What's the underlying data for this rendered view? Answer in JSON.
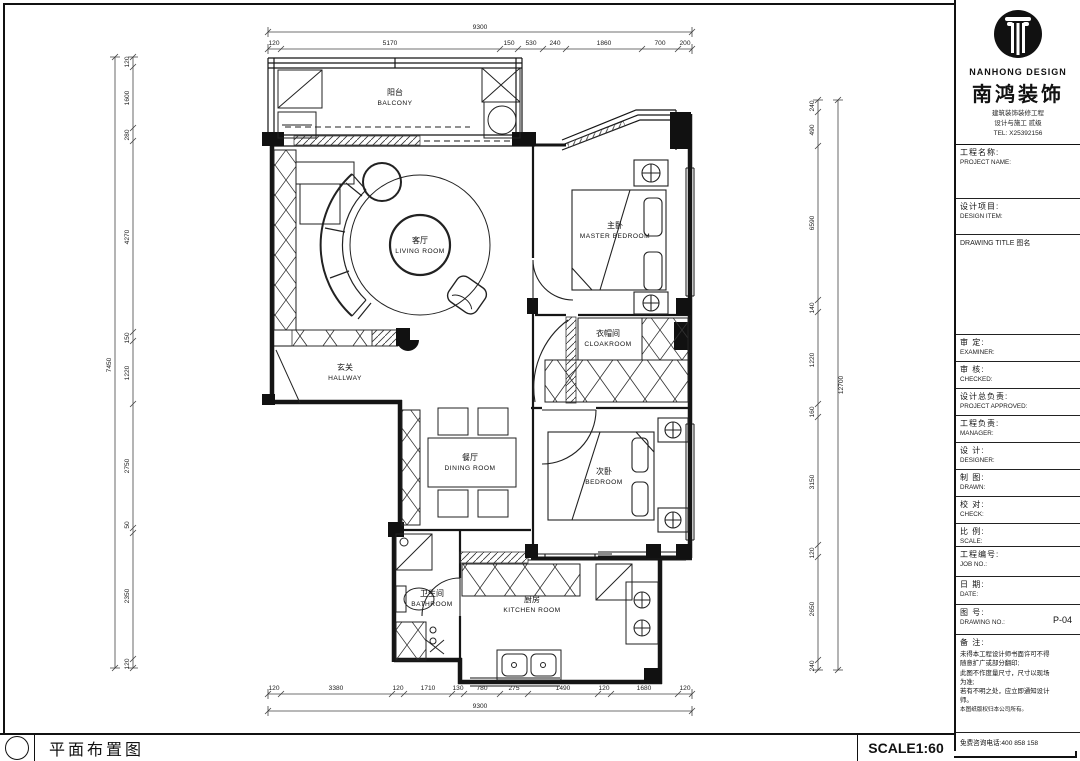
{
  "titlebar": {
    "title": "平面布置图",
    "scale": "SCALE1:60"
  },
  "brand": {
    "name_en": "NANHONG DESIGN",
    "name_cn": "南鸿装饰",
    "sub1": "建筑装饰装修工程",
    "sub2": "设计与施工 贰级",
    "tel": "TEL: X25392156"
  },
  "titleblock": {
    "rows": [
      {
        "cn": "工程名称:",
        "en": "PROJECT NAME:"
      },
      {
        "cn": "设计项目:",
        "en": "DESIGN ITEM:"
      },
      {
        "cn": "DRAWING TITLE 图名",
        "en": ""
      },
      {
        "cn": "审  定:",
        "en": "EXAMINER:"
      },
      {
        "cn": "审  核:",
        "en": "CHECKED:"
      },
      {
        "cn": "设计总负责:",
        "en": "PROJECT APPROVED:"
      },
      {
        "cn": "工程负责:",
        "en": "MANAGER:"
      },
      {
        "cn": "设  计:",
        "en": "DESIGNER:"
      },
      {
        "cn": "制  图:",
        "en": "DRAWN:"
      },
      {
        "cn": "校  对:",
        "en": "CHECK:"
      },
      {
        "cn": "比  例:",
        "en": "SCALE:"
      },
      {
        "cn": "工程编号:",
        "en": "JOB NO.:"
      },
      {
        "cn": "日  期:",
        "en": "DATE:"
      },
      {
        "cn": "图  号:",
        "en": "DRAWING NO.:"
      }
    ],
    "drawing_no": "P-04",
    "remark_title": "备 注:",
    "remarks": [
      "未得本工程设计师书面许可不得",
      "随意扩广或部分翻印;",
      "此图不作度量尺寸，尺寸以现场",
      "为准;",
      "若有不明之处，应立即通知设计",
      "师。",
      "本图纸版权归本公司所有。"
    ],
    "hotline": "免费咨询电话:400 858 158"
  },
  "rooms": [
    {
      "cn": "阳台",
      "en": "BALCONY"
    },
    {
      "cn": "客厅",
      "en": "LIVING ROOM"
    },
    {
      "cn": "主卧",
      "en": "MASTER BEDROOM"
    },
    {
      "cn": "衣帽间",
      "en": "CLOAKROOM"
    },
    {
      "cn": "玄关",
      "en": "HALLWAY"
    },
    {
      "cn": "餐厅",
      "en": "DINING ROOM"
    },
    {
      "cn": "次卧",
      "en": "BEDROOM"
    },
    {
      "cn": "卫生间",
      "en": "BATHROOM"
    },
    {
      "cn": "厨房",
      "en": "KITCHEN ROOM"
    }
  ],
  "dims": {
    "top": {
      "total": "9300",
      "segments": [
        "120",
        "5170",
        "150",
        "530",
        "240",
        "1860",
        "700",
        "200"
      ]
    },
    "bottom": {
      "total": "9300",
      "segments": [
        "120",
        "3380",
        "120",
        "1710",
        "130",
        "780",
        "275",
        "1490",
        "120",
        "1680",
        "120"
      ]
    },
    "left": {
      "total": "7450",
      "segments": [
        "120",
        "1600",
        "280",
        "4270",
        "150",
        "1220",
        "2750",
        "50",
        "2350",
        "120"
      ]
    },
    "right": {
      "total": "12700",
      "segments": [
        "240",
        "490",
        "6590",
        "140",
        "1220",
        "160",
        "3150",
        "120",
        "2650",
        "240"
      ]
    }
  }
}
